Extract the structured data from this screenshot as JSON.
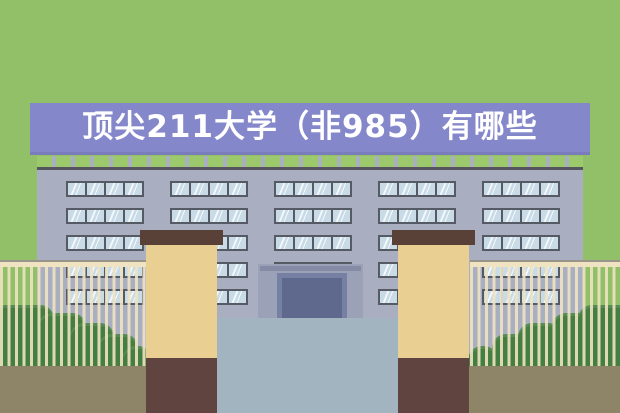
{
  "scene": {
    "title": "顶尖211大学（非985）有哪些",
    "colors": {
      "background": "#91C068",
      "banner": "#8587CB",
      "banner_text": "#FFFFFF",
      "facade": "#AAAEC1",
      "roof_hedge": "#9CC96B",
      "roofline": "#54555F",
      "window_frame": "#565A64",
      "window_glass": "#C9DBE6",
      "window_shine": "#F4F9FC",
      "porch": "#9BA1B6",
      "porch_bar": "#858BA4",
      "door_frame": "#7680A3",
      "door": "#5E698D",
      "courtyard": "#A2B4BF",
      "ground": "#8E8568",
      "bush": "#457E41",
      "fence": "#EFE3C1",
      "pillar_cap": "#5A4138",
      "pillar_body": "#E9CF92",
      "pillar_base": "#5F443F"
    },
    "layout": {
      "window_group_x": [
        29,
        133,
        237,
        341,
        445
      ],
      "window_row_y": [
        25,
        52,
        79,
        106,
        133
      ],
      "bushes_left": [
        [
          -8,
          62,
          305
        ],
        [
          38,
          48,
          313
        ],
        [
          70,
          44,
          323
        ],
        [
          98,
          40,
          334
        ],
        [
          122,
          30,
          346
        ]
      ],
      "bushes_right": [
        [
          468,
          30,
          346
        ],
        [
          492,
          40,
          334
        ],
        [
          518,
          44,
          323
        ],
        [
          552,
          48,
          313
        ],
        [
          578,
          62,
          305
        ]
      ]
    }
  }
}
